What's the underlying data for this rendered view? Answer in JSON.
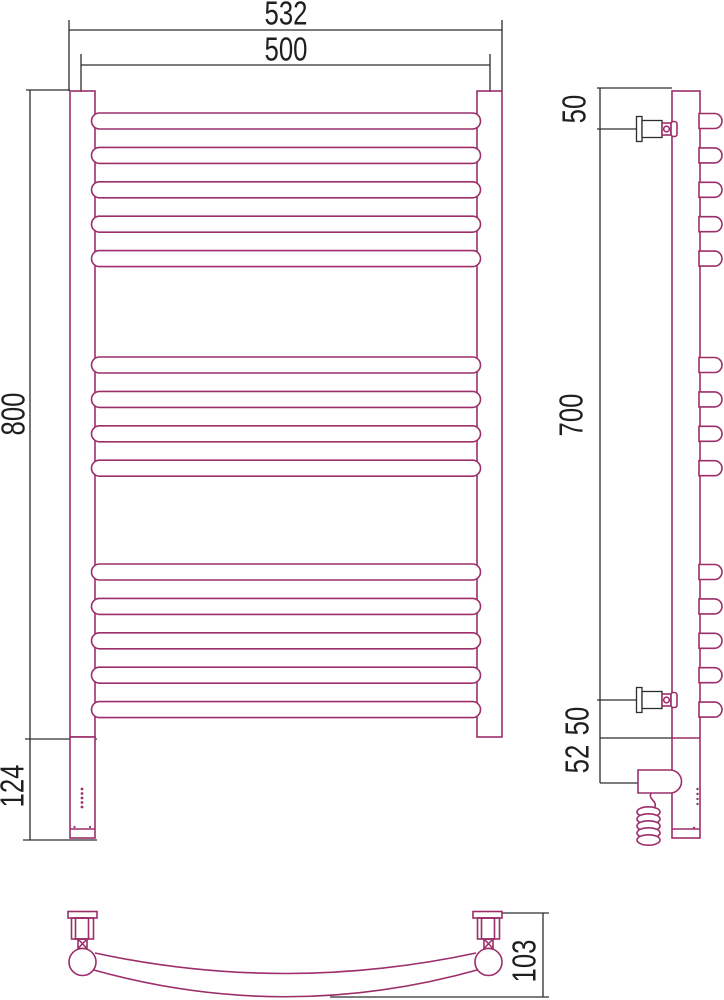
{
  "front_view": {
    "width_overall": "532",
    "width_between_axes": "500",
    "height": "800",
    "heater_box_height": "124",
    "bar_groups": [
      5,
      4,
      5
    ]
  },
  "side_view": {
    "top_bracket_offset": "50",
    "bracket_distance": "700",
    "bottom_bracket_offset": "50",
    "heater_axis_offset": "52"
  },
  "bottom_view": {
    "depth": "103"
  },
  "colors": {
    "product_line": "#9c2e6a",
    "dimension_line": "#2d2d2d"
  }
}
